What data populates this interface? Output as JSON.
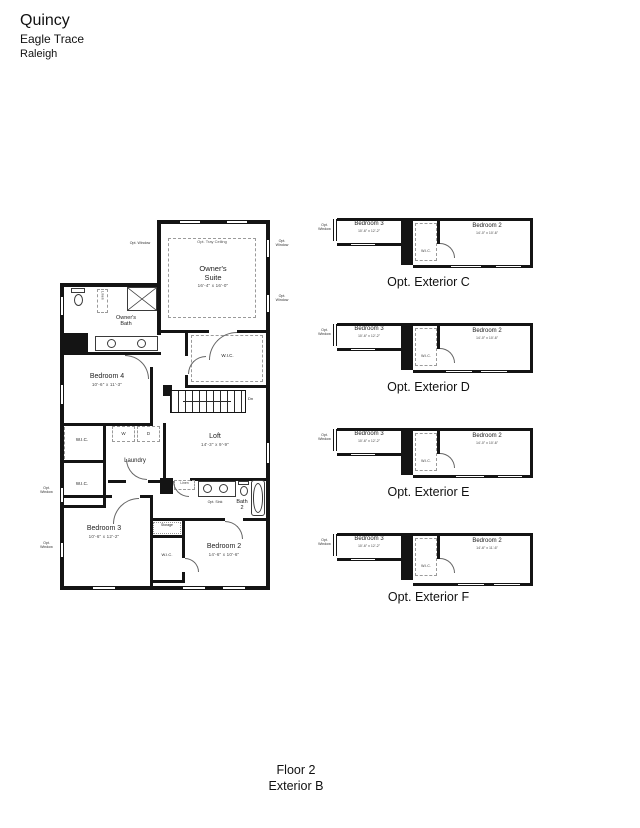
{
  "header": {
    "title": "Quincy",
    "community": "Eagle Trace",
    "city": "Raleigh"
  },
  "footer": {
    "floor": "Floor 2",
    "exterior": "Exterior B"
  },
  "plan": {
    "owners_suite": {
      "name1": "Owner's",
      "name2": "Suite",
      "dims": "16'-4\" x 16'-0\""
    },
    "owners_bath": {
      "name1": "Owner's",
      "name2": "Bath"
    },
    "bedroom4": {
      "name": "Bedroom 4",
      "dims": "10'-6\" x 11'-3\""
    },
    "laundry": {
      "name": "Laundry"
    },
    "loft": {
      "name": "Loft",
      "dims": "14'-3\" x 9'-9\""
    },
    "bath2": {
      "name1": "Bath",
      "name2": "2"
    },
    "bedroom3": {
      "name": "Bedroom 3",
      "dims": "10'-6\" x 12'-2\""
    },
    "bedroom2": {
      "name": "Bedroom 2",
      "dims": "14'-6\" x 10'-6\""
    },
    "labels": {
      "wic": "W.I.C.",
      "linen": "Linen",
      "storage": "Storage",
      "opt_window": "Opt. Window",
      "tray": "Opt. Tray Ceiling",
      "opt_sink": "Opt. Sink",
      "washer": "W",
      "dryer": "D",
      "dn": "Dn"
    }
  },
  "options": [
    {
      "caption": "Opt. Exterior C",
      "bedroom3_name": "Bedroom 3",
      "bedroom3_dims": "10'-6\" x 12'-2\"",
      "bedroom2_name": "Bedroom 2",
      "bedroom2_dims": "14'-0\" x 10'-6\"",
      "wic": "W.I.C.",
      "opt_window": "Opt. Window"
    },
    {
      "caption": "Opt. Exterior D",
      "bedroom3_name": "Bedroom 3",
      "bedroom3_dims": "10'-6\" x 12'-2\"",
      "bedroom2_name": "Bedroom 2",
      "bedroom2_dims": "14'-0\" x 10'-6\"",
      "wic": "W.I.C.",
      "opt_window": "Opt. Window"
    },
    {
      "caption": "Opt. Exterior E",
      "bedroom3_name": "Bedroom 3",
      "bedroom3_dims": "10'-6\" x 12'-2\"",
      "bedroom2_name": "Bedroom 2",
      "bedroom2_dims": "14'-0\" x 10'-6\"",
      "wic": "W.I.C.",
      "opt_window": "Opt. Window"
    },
    {
      "caption": "Opt. Exterior F",
      "bedroom3_name": "Bedroom 3",
      "bedroom3_dims": "10'-6\" x 12'-2\"",
      "bedroom2_name": "Bedroom 2",
      "bedroom2_dims": "14'-6\" x 11'-6\"",
      "wic": "W.I.C.",
      "opt_window": "Opt. Window"
    }
  ]
}
